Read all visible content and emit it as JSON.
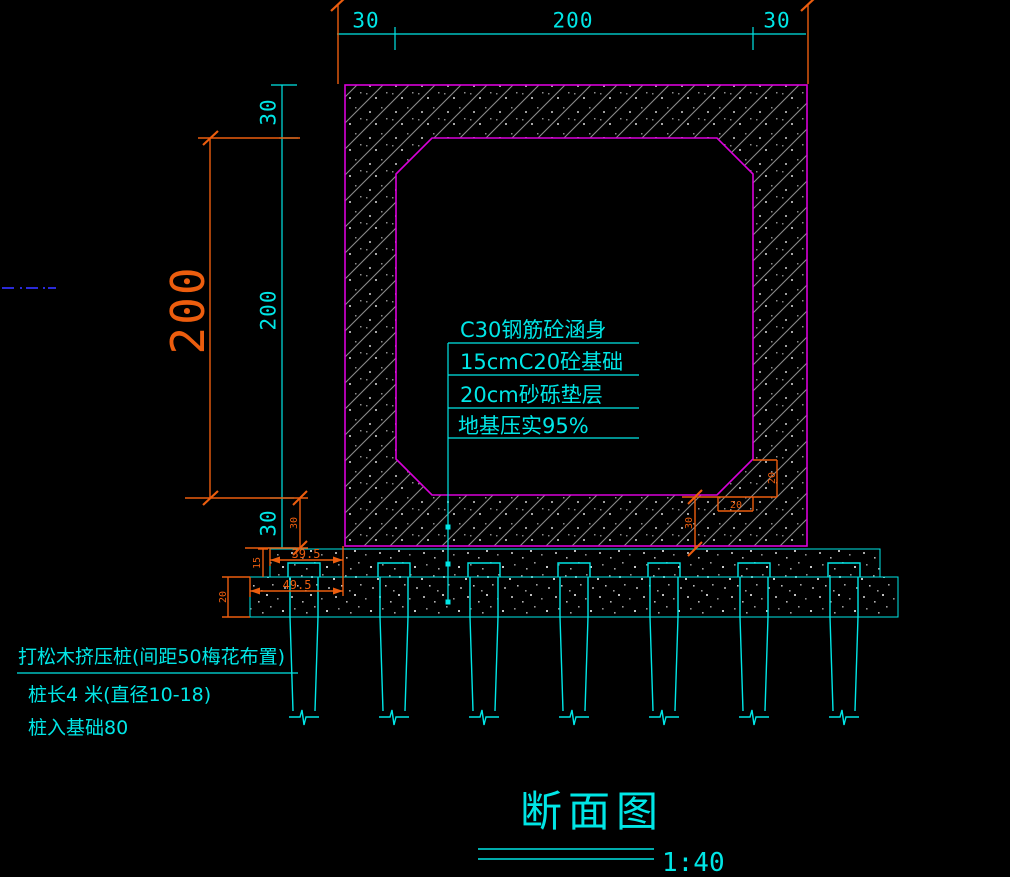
{
  "drawing": {
    "title": "断面图",
    "scale": "1:40"
  },
  "dims": {
    "top": {
      "left": "30",
      "mid": "200",
      "right": "30"
    },
    "left": {
      "seg_top": "30",
      "seg_mid": "200",
      "seg_bottom": "30",
      "overall": "200"
    },
    "detail": {
      "slab_left": "30",
      "slab_right": "30",
      "layer1_offset": "39.5",
      "layer2_offset": "49.5",
      "layer1_thickness": "15",
      "layer2_thickness": "20",
      "chamfer_width": "20",
      "chamfer_height": "20"
    }
  },
  "annotations": {
    "line1": "C30钢筋砼涵身",
    "line2": "15cmC20砼基础",
    "line3": "20cm砂砾垫层",
    "line4": "地基压实95%"
  },
  "pile_notes": {
    "line1": "打松木挤压桩(间距50梅花布置)",
    "line2": "桩长4 米(直径10-18)",
    "line3": "桩入基础80"
  },
  "figure": {
    "type": "culvert-cross-section",
    "pile_count": 7,
    "colors": {
      "background": "#000000",
      "dimension_cyan": "#00e6e6",
      "outline_magenta": "#d900d9",
      "dimension_orange": "#ec5d0e",
      "hatch_gray": "#8a8a8a",
      "dash_blue": "#2a2ad8"
    }
  }
}
